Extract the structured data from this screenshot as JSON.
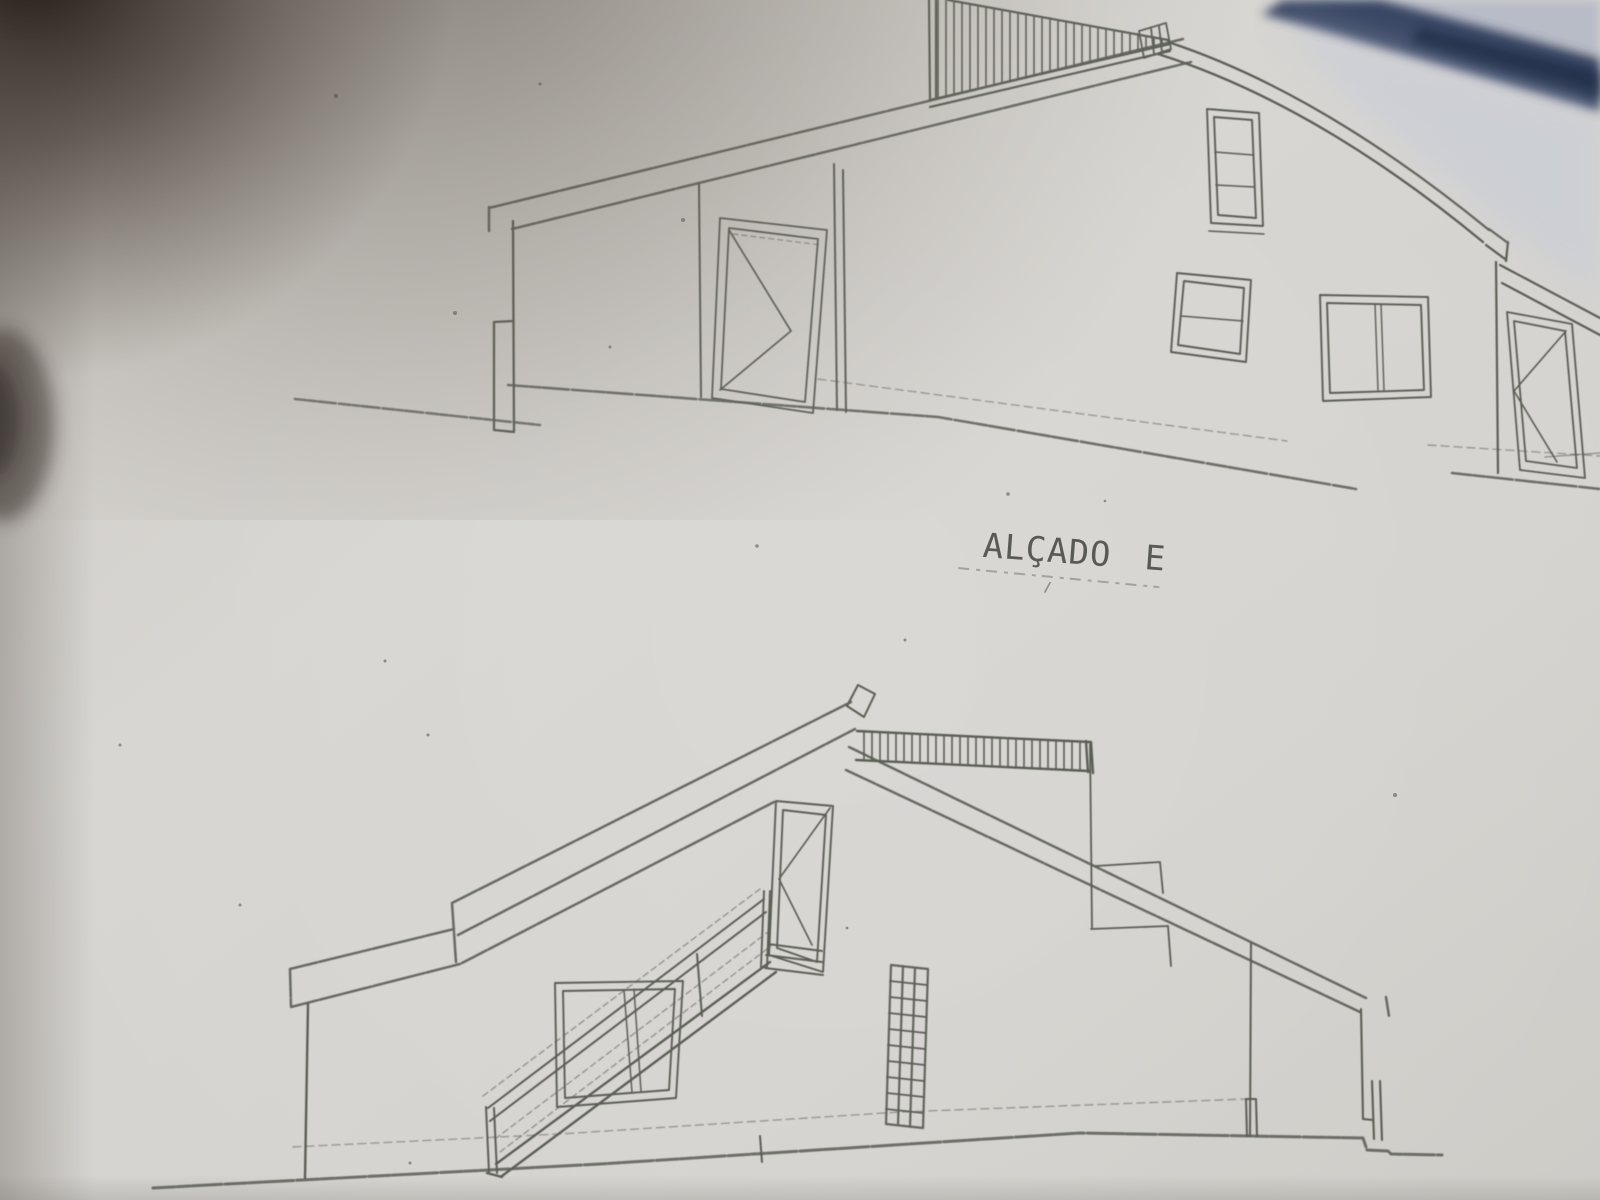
{
  "drawing": {
    "label": "ALÇADO E"
  },
  "colors": {
    "paper": "#d4d2cd",
    "pencil": "#4f544a",
    "pencil_dark": "#3e4339",
    "label_ink": "#3c4137",
    "blue_edge": "#33405e",
    "blue_wash": "#c2c9da",
    "shadow": "#17100a"
  }
}
